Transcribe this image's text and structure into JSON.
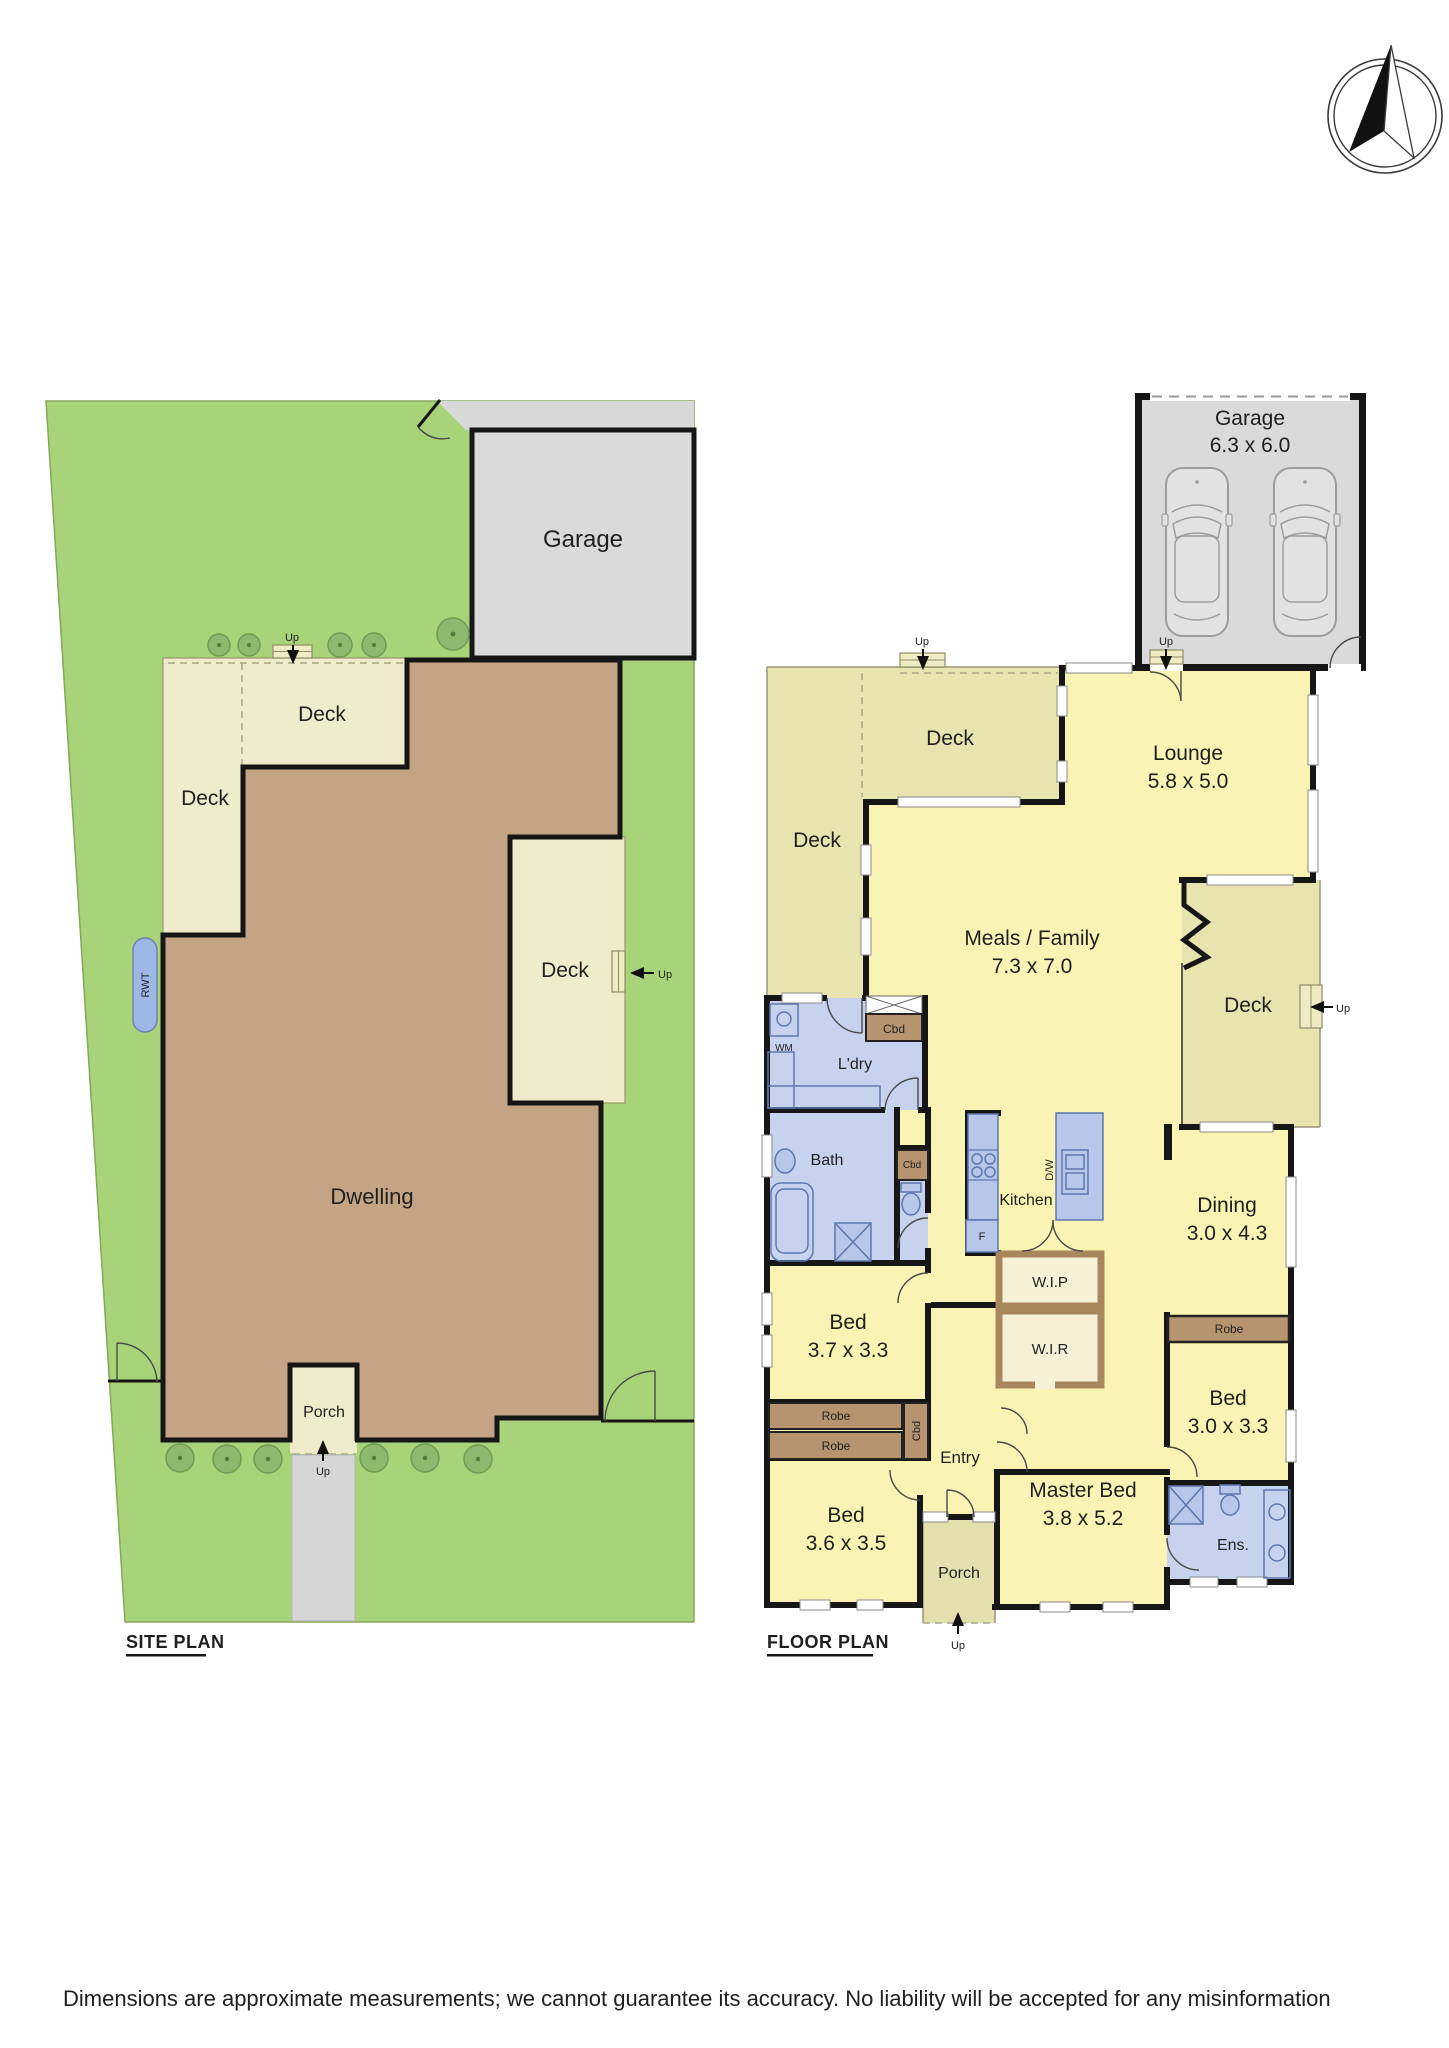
{
  "site_plan": {
    "title": "SITE PLAN",
    "garage": "Garage",
    "dwelling": "Dwelling",
    "deck": "Deck",
    "porch": "Porch",
    "rwt": "RWT",
    "up": "Up"
  },
  "floor_plan": {
    "title": "FLOOR PLAN",
    "rooms": {
      "garage": {
        "name": "Garage",
        "dim": "6.3 x 6.0"
      },
      "lounge": {
        "name": "Lounge",
        "dim": "5.8 x 5.0"
      },
      "meals": {
        "name": "Meals / Family",
        "dim": "7.3 x 7.0"
      },
      "dining": {
        "name": "Dining",
        "dim": "3.0 x 4.3"
      },
      "bed1": {
        "name": "Bed",
        "dim": "3.7 x 3.3"
      },
      "bed2": {
        "name": "Bed",
        "dim": "3.0 x 3.3"
      },
      "bed3": {
        "name": "Bed",
        "dim": "3.6 x 3.5"
      },
      "master": {
        "name": "Master Bed",
        "dim": "3.8 x 5.2"
      }
    },
    "labels": {
      "deck": "Deck",
      "ldry": "L'dry",
      "bath": "Bath",
      "ens": "Ens.",
      "kitchen": "Kitchen",
      "wip": "W.I.P",
      "wir": "W.I.R",
      "entry": "Entry",
      "porch": "Porch",
      "robe": "Robe",
      "cbd": "Cbd",
      "wm": "WM",
      "fridge": "F",
      "dw": "D/W",
      "up": "Up"
    }
  },
  "disclaimer": "Dimensions are approximate measurements; we cannot guarantee its accuracy. No liability will be accepted for any misinformation",
  "colors": {
    "lot_green": "#a8d379",
    "tree_green": "#8cb96e",
    "dwelling_brown": "#c4a484",
    "deck_cream": "#efeccb",
    "interior_yellow": "#f9f3b4",
    "wet_blue": "#c6d2ee",
    "robe_brown": "#b5946f",
    "garage_gray": "#dadada",
    "wall_black": "#161616"
  }
}
